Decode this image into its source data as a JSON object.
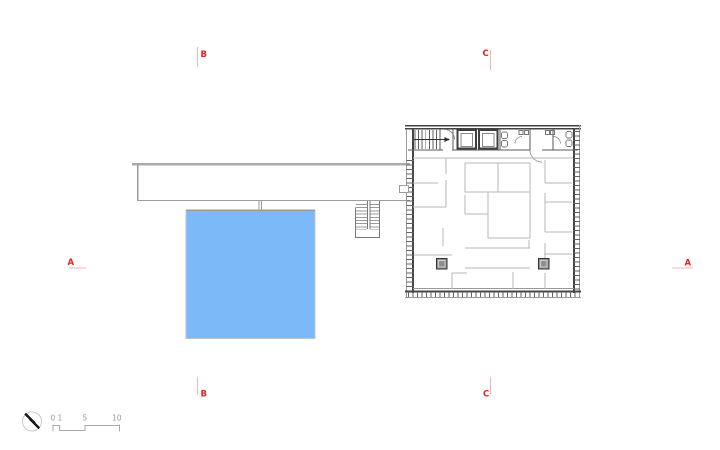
{
  "section_markers": {
    "top_b": {
      "label": "B"
    },
    "top_c": {
      "label": "C"
    },
    "left_a": {
      "label": "A"
    },
    "right_a": {
      "label": "A"
    },
    "bottom_b": {
      "label": "B"
    },
    "bottom_c": {
      "label": "C"
    }
  },
  "scale_bar": {
    "labels": {
      "zero": "0",
      "one": "1",
      "five": "5",
      "ten": "10"
    }
  },
  "colors": {
    "marker_red": "#e0231c",
    "marker_line": "#f4b6b1",
    "pool_blue": "#7cb9f8",
    "wall_dark": "#444444",
    "partition_gray": "#b7b7b7",
    "bar_gray": "#ababab"
  }
}
